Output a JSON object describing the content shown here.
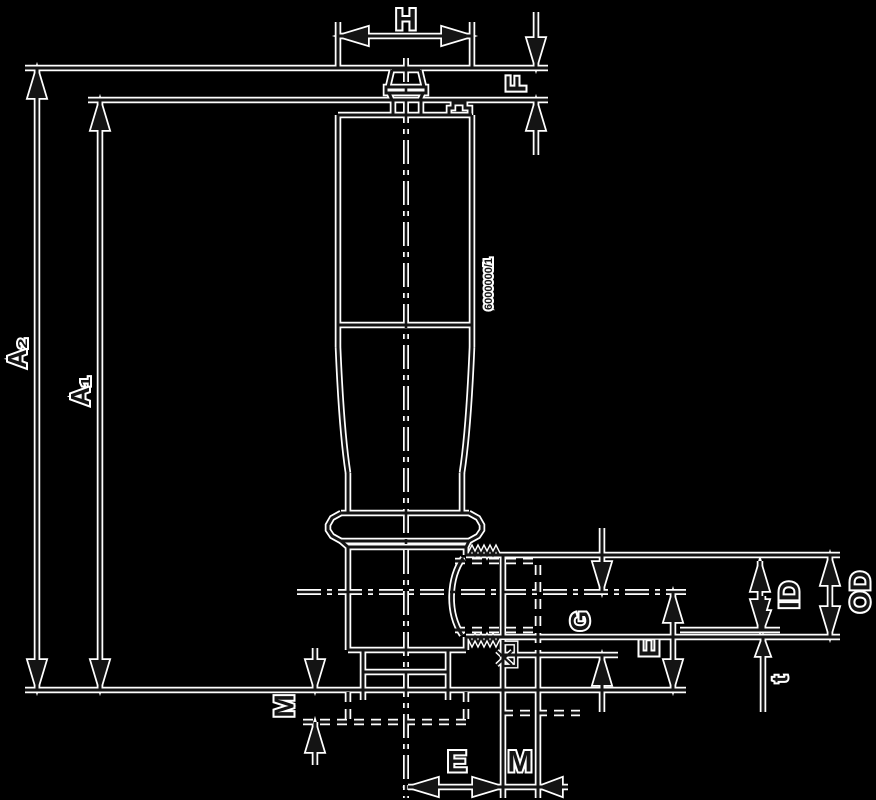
{
  "diagram": {
    "title": "Tank-bottom valve dimensional drawing",
    "colors": {
      "background": "#000000",
      "ink": "#141414",
      "halo": "#ffffff"
    },
    "labels": [
      {
        "id": "dim-H",
        "text": "H",
        "x": 406,
        "y": 20,
        "rotate": 0,
        "size": 30
      },
      {
        "id": "dim-F",
        "text": "F",
        "x": 516,
        "y": 84,
        "rotate": -90,
        "size": 28
      },
      {
        "id": "dim-A2",
        "text": "A₂",
        "x": 17,
        "y": 353,
        "rotate": -90,
        "size": 26
      },
      {
        "id": "dim-A1",
        "text": "A₁",
        "x": 80,
        "y": 391,
        "rotate": -90,
        "size": 26
      },
      {
        "id": "dim-M-left",
        "text": "M",
        "x": 284,
        "y": 706,
        "rotate": -90,
        "size": 28
      },
      {
        "id": "dim-G",
        "text": "G",
        "x": 580,
        "y": 621,
        "rotate": -90,
        "size": 26
      },
      {
        "id": "dim-E-side",
        "text": "E",
        "x": 649,
        "y": 648,
        "rotate": -90,
        "size": 28
      },
      {
        "id": "dim-ID",
        "text": "ID",
        "x": 789,
        "y": 595,
        "rotate": -90,
        "size": 28
      },
      {
        "id": "dim-OD",
        "text": "OD",
        "x": 860,
        "y": 592,
        "rotate": -90,
        "size": 28
      },
      {
        "id": "dim-t",
        "text": "t",
        "x": 780,
        "y": 679,
        "rotate": -90,
        "size": 22
      },
      {
        "id": "dim-E-bottom",
        "text": "E",
        "x": 457,
        "y": 762,
        "rotate": 0,
        "size": 30
      },
      {
        "id": "dim-M-bottom",
        "text": "M",
        "x": 520,
        "y": 762,
        "rotate": 0,
        "size": 30
      },
      {
        "id": "body-code",
        "text": "6000000/1",
        "x": 489,
        "y": 284,
        "rotate": -90,
        "size": 11
      }
    ]
  }
}
